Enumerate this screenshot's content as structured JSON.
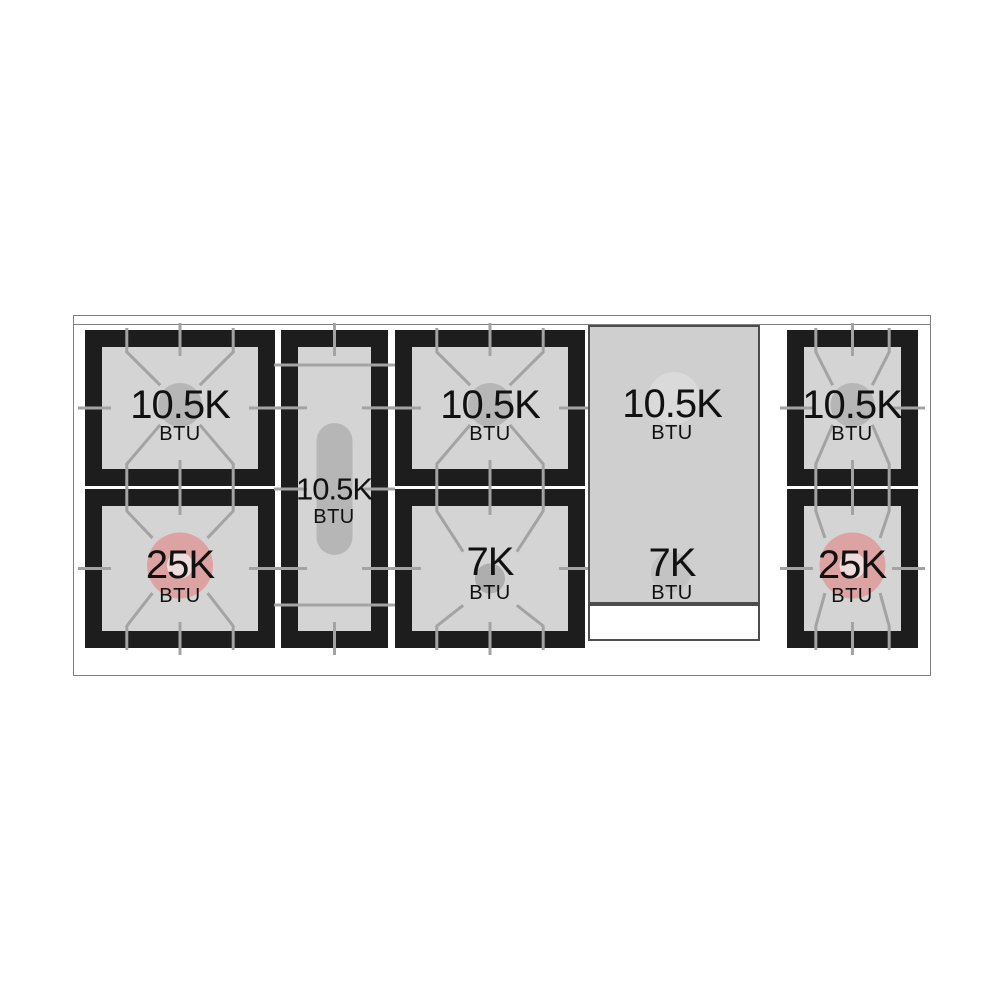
{
  "diagram": {
    "kind": "range-cooktop-burner-layout",
    "burners": [
      {
        "id": "left-rear",
        "power": "10.5K",
        "unit": "BTU"
      },
      {
        "id": "left-front",
        "power": "25K",
        "unit": "BTU"
      },
      {
        "id": "center-oval",
        "power": "10.5K",
        "unit": "BTU"
      },
      {
        "id": "middle-rear",
        "power": "10.5K",
        "unit": "BTU"
      },
      {
        "id": "middle-front",
        "power": "7K",
        "unit": "BTU"
      },
      {
        "id": "griddle-rear",
        "power": "10.5K",
        "unit": "BTU"
      },
      {
        "id": "griddle-front",
        "power": "7K",
        "unit": "BTU"
      },
      {
        "id": "right-rear",
        "power": "10.5K",
        "unit": "BTU"
      },
      {
        "id": "right-front",
        "power": "25K",
        "unit": "BTU"
      }
    ],
    "colors": {
      "grate": "#1d1d1d",
      "cell_surface": "#d4d4d4",
      "grate_lines": "#a3a3a3",
      "burner": "#b6b6b6",
      "burner_high": "#dda3a3",
      "burner_high_cap": "#efdcdc",
      "burner_small": "#aeaeae",
      "griddle_surface": "#cfcfcf",
      "griddle_handle": "#ffffff",
      "griddle_burner_rear": "#dadada",
      "griddle_burner_front": "#c3c3c3",
      "frame_border": "#7f7f7f"
    }
  }
}
